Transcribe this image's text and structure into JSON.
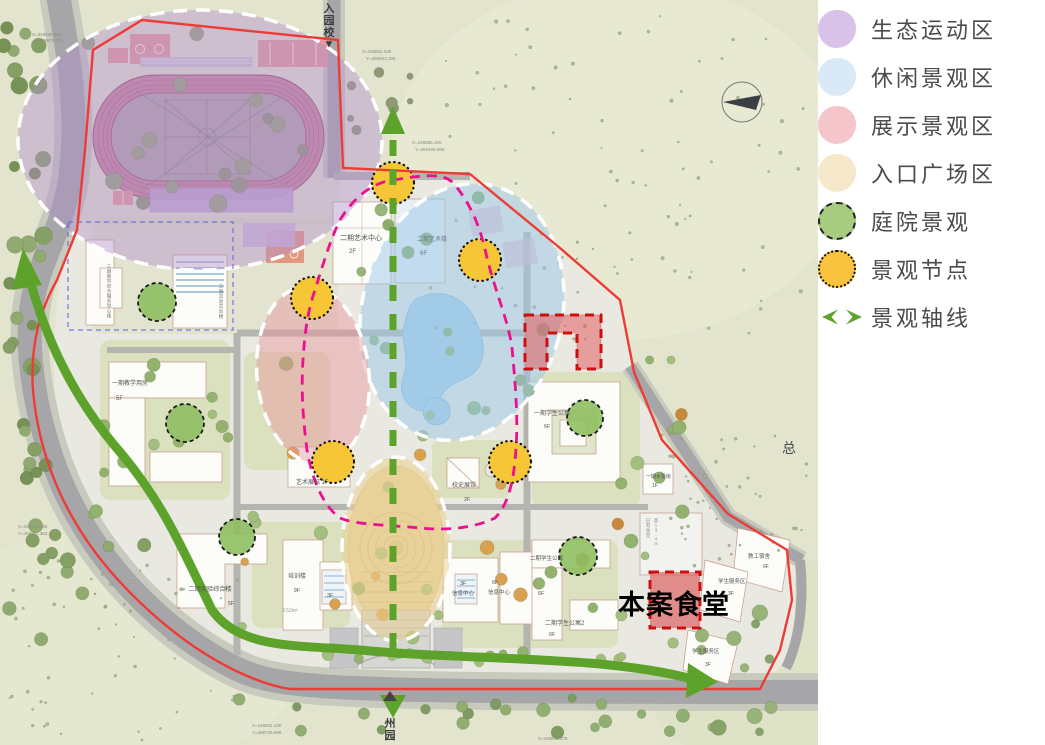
{
  "legend": {
    "items": [
      {
        "label": "生态运动区",
        "swatch": "circle",
        "color": "#d9c2ea"
      },
      {
        "label": "休闲景观区",
        "swatch": "circle",
        "color": "#d9e9f8"
      },
      {
        "label": "展示景观区",
        "swatch": "circle",
        "color": "#f5c5cc"
      },
      {
        "label": "入口广场区",
        "swatch": "circle",
        "color": "#f6e9cb"
      },
      {
        "label": "庭院景观",
        "swatch": "circle-dashed",
        "color": "#a6cb81"
      },
      {
        "label": "景观节点",
        "swatch": "circle-dotted",
        "color": "#fac33d"
      },
      {
        "label": "景观轴线",
        "swatch": "axis-arrows",
        "color": "#5da32b"
      }
    ]
  },
  "map": {
    "highlight_label": "本案食堂",
    "axis_color": "#5da32b",
    "boundary_color": "#ee3b35",
    "node_color": "#f7c637",
    "courtyard_color": "#8fbf62",
    "labels": [
      {
        "t": "入园校▼",
        "x": 329,
        "y": 12,
        "s": 11,
        "st": 1,
        "c": "#3c3c3c",
        "w": 700
      },
      {
        "t": "州园",
        "x": 390,
        "y": 727,
        "s": 11,
        "st": 1,
        "c": "#3c3c3c",
        "w": 700
      },
      {
        "t": "二期艺术中心",
        "x": 361,
        "y": 240,
        "s": 7,
        "a": "middle",
        "c": "#555555"
      },
      {
        "t": "2F",
        "x": 349,
        "y": 253,
        "s": 6,
        "c": "#555555"
      },
      {
        "t": "二期艺术楼",
        "x": 417,
        "y": 241,
        "s": 6,
        "c": "#6b7b8a"
      },
      {
        "t": "6F",
        "x": 420,
        "y": 255,
        "s": 6,
        "c": "#6b7b8a"
      },
      {
        "t": "一期教学用房",
        "x": 112,
        "y": 385,
        "s": 6,
        "c": "#555555"
      },
      {
        "t": "5F",
        "x": 116,
        "y": 400,
        "s": 6,
        "c": "#555555"
      },
      {
        "t": "三期教学综合服务中心楼",
        "x": 109,
        "y": 268,
        "s": 4.6,
        "st": 1,
        "c": "#777777"
      },
      {
        "t": "三期实验实训楼",
        "x": 221,
        "y": 288,
        "s": 4.6,
        "st": 1,
        "c": "#777777"
      },
      {
        "t": "二期实验综合楼",
        "x": 210,
        "y": 591,
        "s": 6.2,
        "a": "middle",
        "c": "#555555"
      },
      {
        "t": "5F",
        "x": 228,
        "y": 605,
        "s": 5.5,
        "c": "#555555"
      },
      {
        "t": "培训楼",
        "x": 297,
        "y": 578,
        "s": 6,
        "a": "middle",
        "c": "#555555"
      },
      {
        "t": "9F",
        "x": 297,
        "y": 592,
        "s": 5.5,
        "a": "middle",
        "c": "#555555"
      },
      {
        "t": "3F",
        "x": 327,
        "y": 597,
        "s": 5.5,
        "c": "#555555"
      },
      {
        "t": "3.52m²",
        "x": 282,
        "y": 612,
        "s": 5,
        "c": "#999999"
      },
      {
        "t": "艺术展馆 1F",
        "x": 296,
        "y": 484,
        "s": 6,
        "c": "#555555"
      },
      {
        "t": "校史展馆",
        "x": 452,
        "y": 487,
        "s": 6,
        "c": "#555555"
      },
      {
        "t": "2F",
        "x": 464,
        "y": 501,
        "s": 5.5,
        "c": "#555555"
      },
      {
        "t": "3F",
        "x": 460,
        "y": 585,
        "s": 5.5,
        "c": "#555555"
      },
      {
        "t": "信息中心",
        "x": 452,
        "y": 595,
        "s": 5.5,
        "c": "#555555"
      },
      {
        "t": "6F",
        "x": 492,
        "y": 584,
        "s": 5.5,
        "c": "#555555"
      },
      {
        "t": "信息中心",
        "x": 488,
        "y": 594,
        "s": 5.5,
        "c": "#555555"
      },
      {
        "t": "二期学生公寓",
        "x": 530,
        "y": 560,
        "s": 5.5,
        "c": "#555555"
      },
      {
        "t": "6F",
        "x": 538,
        "y": 595,
        "s": 5.5,
        "c": "#555555"
      },
      {
        "t": "二期学生公寓2",
        "x": 545,
        "y": 625,
        "s": 6,
        "c": "#555555"
      },
      {
        "t": "6F",
        "x": 549,
        "y": 636,
        "s": 5.5,
        "c": "#555555"
      },
      {
        "t": "一期学生公寓",
        "x": 534,
        "y": 415,
        "s": 6,
        "c": "#555555"
      },
      {
        "t": "6F",
        "x": 544,
        "y": 428,
        "s": 5.5,
        "c": "#555555"
      },
      {
        "t": "一期水泵房",
        "x": 646,
        "y": 478,
        "s": 5,
        "c": "#555555"
      },
      {
        "t": "1F",
        "x": 652,
        "y": 487,
        "s": 5,
        "c": "#555555"
      },
      {
        "t": "已有食堂",
        "x": 648,
        "y": 522,
        "s": 4.6,
        "st": 1,
        "c": "#8a8a8a"
      },
      {
        "t": "高13.4m",
        "x": 656,
        "y": 522,
        "s": 4.3,
        "st": 1,
        "c": "#8a8a8a"
      },
      {
        "t": "教工宿舍",
        "x": 748,
        "y": 558,
        "s": 5.5,
        "c": "#555555"
      },
      {
        "t": "6F",
        "x": 763,
        "y": 568,
        "s": 5,
        "c": "#555555"
      },
      {
        "t": "学生服务区",
        "x": 718,
        "y": 583,
        "s": 5.5,
        "c": "#555555"
      },
      {
        "t": "3F",
        "x": 728,
        "y": 595,
        "s": 5,
        "c": "#555555"
      },
      {
        "t": "学生服务区",
        "x": 692,
        "y": 653,
        "s": 5.5,
        "c": "#555555"
      },
      {
        "t": "3F",
        "x": 705,
        "y": 666,
        "s": 5,
        "c": "#555555"
      },
      {
        "t": "本案食堂",
        "x": 674,
        "y": 614,
        "s": 27,
        "w": 900,
        "c": "#000000",
        "a": "middle",
        "ls": 1
      },
      {
        "t": "总",
        "x": 782,
        "y": 453,
        "s": 14,
        "c": "#4a4a4a"
      },
      {
        "t": "X=348835.343",
        "x": 32,
        "y": 36,
        "s": 4.5,
        "c": "#8a8a80"
      },
      {
        "t": "Y=468878.775",
        "x": 34,
        "y": 42,
        "s": 4.5,
        "c": "#8a8a80"
      },
      {
        "t": "X=348834.035",
        "x": 362,
        "y": 53,
        "s": 4.5,
        "c": "#8a8a80"
      },
      {
        "t": "Y=468463.186",
        "x": 366,
        "y": 60,
        "s": 4.5,
        "c": "#8a8a80"
      },
      {
        "t": "X=348885.450",
        "x": 412,
        "y": 144,
        "s": 4.5,
        "c": "#8a8a80"
      },
      {
        "t": "Y=466405.566",
        "x": 415,
        "y": 151,
        "s": 4.5,
        "c": "#8a8a80"
      },
      {
        "t": "X=348871.180",
        "x": 18,
        "y": 528,
        "s": 4.5,
        "c": "#8a8a80"
      },
      {
        "t": "Y=468857.363",
        "x": 18,
        "y": 535,
        "s": 4.5,
        "c": "#8a8a80"
      },
      {
        "t": "X=348841.430",
        "x": 252,
        "y": 727,
        "s": 4.5,
        "c": "#8a8a80"
      },
      {
        "t": "Y=468725.689",
        "x": 252,
        "y": 734,
        "s": 4.5,
        "c": "#8a8a80"
      },
      {
        "t": "X=348836.275",
        "x": 538,
        "y": 740,
        "s": 4.5,
        "c": "#8a8a80"
      }
    ]
  }
}
